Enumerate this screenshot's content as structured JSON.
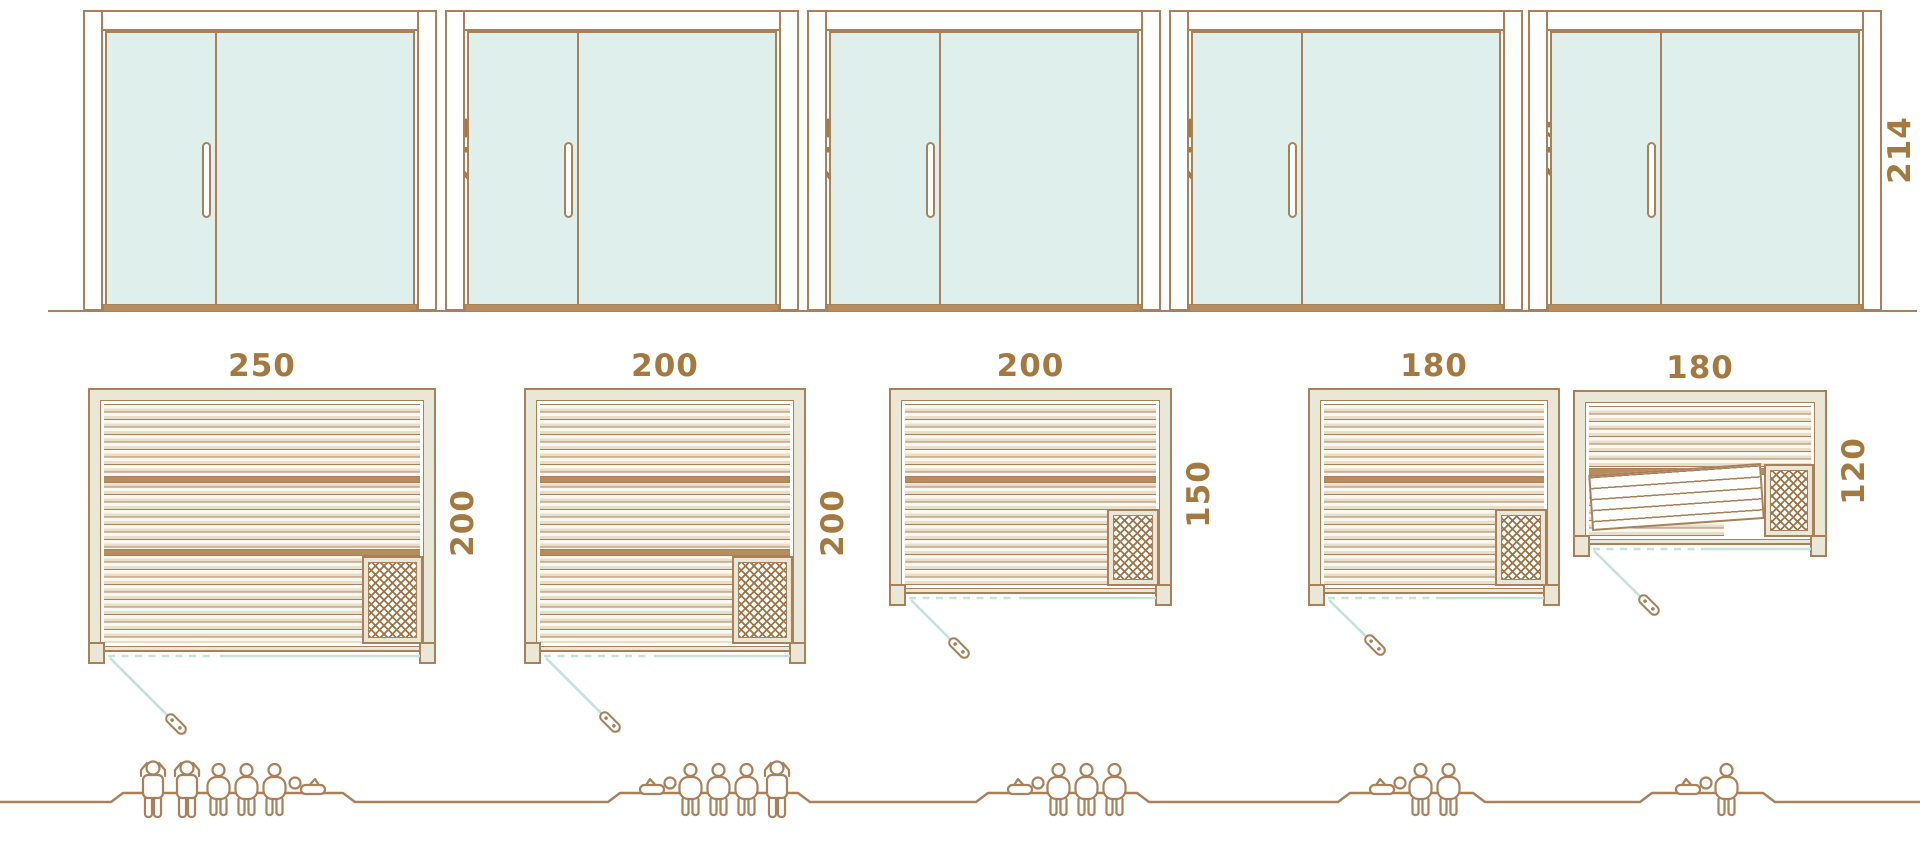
{
  "title": "Sauna size comparison diagram",
  "palette": {
    "line": "#a8815a",
    "text": "#a3793f",
    "glass": "#dff0ec",
    "wall": "#ebe7d6",
    "teal": "#c2e2dc",
    "slat": "#e7dfc9",
    "sill": "#b68e5d",
    "hatch": "#9c7547"
  },
  "units": [
    {
      "name": "sauna-250x200",
      "elevation": {
        "height_label": "214"
      },
      "plan": {
        "width_label": "250",
        "depth_label": "200"
      },
      "capacity": {
        "people_count": 6,
        "figures": [
          "standing",
          "standing",
          "seated",
          "seated",
          "seated",
          "reclining-right"
        ]
      }
    },
    {
      "name": "sauna-200x200",
      "elevation": {
        "height_label": "214"
      },
      "plan": {
        "width_label": "200",
        "depth_label": "200"
      },
      "capacity": {
        "people_count": 5,
        "figures": [
          "reclining-left",
          "seated",
          "seated",
          "seated",
          "standing"
        ]
      }
    },
    {
      "name": "sauna-200x150",
      "elevation": {
        "height_label": "214"
      },
      "plan": {
        "width_label": "200",
        "depth_label": "150"
      },
      "capacity": {
        "people_count": 4,
        "figures": [
          "reclining-left",
          "seated",
          "seated",
          "seated"
        ]
      }
    },
    {
      "name": "sauna-180x150",
      "elevation": {
        "height_label": "214"
      },
      "plan": {
        "width_label": "180",
        "depth_label": "150"
      },
      "capacity": {
        "people_count": 3,
        "figures": [
          "reclining-left",
          "seated",
          "seated"
        ]
      }
    },
    {
      "name": "sauna-180x120",
      "elevation": {
        "height_label": "214"
      },
      "plan": {
        "width_label": "180",
        "depth_label": "120"
      },
      "capacity": {
        "people_count": 2,
        "figures": [
          "reclining-left",
          "seated"
        ]
      }
    }
  ]
}
